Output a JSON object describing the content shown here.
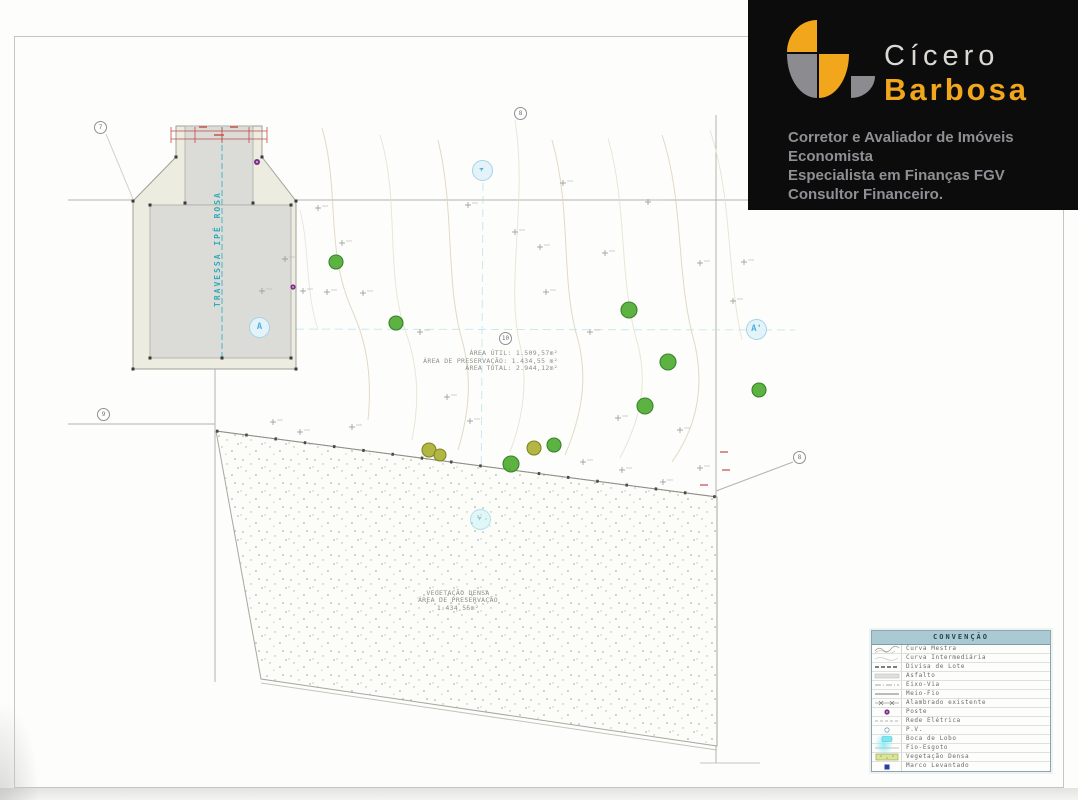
{
  "colors": {
    "accent_yellow": "#F1A61C",
    "logo_gray": "#8B8B90",
    "teal": "#2FAAB8",
    "tree_green": "#55B039",
    "pole_purple": "#7C2F86",
    "survey_marker_blue": "#2A3F9F",
    "storm_drain_cyan": "#7EE7F2",
    "legend_header": "#A9CAD2"
  },
  "logo": {
    "name_line1": "Cícero",
    "name_line2": "Barbosa",
    "taglines": [
      "Corretor e Avaliador de Imóveis",
      "Economista",
      "Especialista em Finanças FGV",
      "Consultor Financeiro."
    ]
  },
  "icons": {
    "section_arrow": "➤"
  },
  "plan": {
    "street_label": "TRAVESSA IPÊ ROSA",
    "area_summary": {
      "util_label": "ÁREA ÚTIL:",
      "util_value": "1.509,57m²",
      "preservacao_label": "ÁREA DE PRESERVAÇÃO:",
      "preservacao_value": "1.434,55 m²",
      "total_label": "ÁREA TOTAL:",
      "total_value": "2.944,12m²"
    },
    "preservation_area": {
      "line1": "VEGETAÇÃO DENSA",
      "line2": "ÁREA DE PRESERVAÇÃO",
      "line3": "1.434,55m²"
    },
    "sections": {
      "left": "A",
      "right": "A'"
    },
    "nodes": [
      "7",
      "8",
      "9",
      "10",
      "8"
    ]
  },
  "legend": {
    "title": "CONVENÇÃO",
    "items": [
      {
        "icon": "contour-major-icon",
        "label": "Curva Mestra"
      },
      {
        "icon": "contour-intermediate-icon",
        "label": "Curva Intermediária"
      },
      {
        "icon": "lot-boundary-icon",
        "label": "Divisa de Lote"
      },
      {
        "icon": "asphalt-icon",
        "label": "Asfalto"
      },
      {
        "icon": "road-axis-icon",
        "label": "Eixo-Via"
      },
      {
        "icon": "curb-icon",
        "label": "Meio-Fio"
      },
      {
        "icon": "fence-icon",
        "label": "Alambrado existente"
      },
      {
        "icon": "pole-icon",
        "label": "Poste"
      },
      {
        "icon": "power-line-icon",
        "label": "Rede Elétrica"
      },
      {
        "icon": "manhole-icon",
        "label": "P.V."
      },
      {
        "icon": "storm-drain-icon",
        "label": "Boca de Lobo"
      },
      {
        "icon": "sewer-line-icon",
        "label": "Fio-Esgoto"
      },
      {
        "icon": "dense-vegetation-icon",
        "label": "Vegetação Densa"
      },
      {
        "icon": "survey-marker-icon",
        "label": "Marco Levantado"
      }
    ]
  }
}
